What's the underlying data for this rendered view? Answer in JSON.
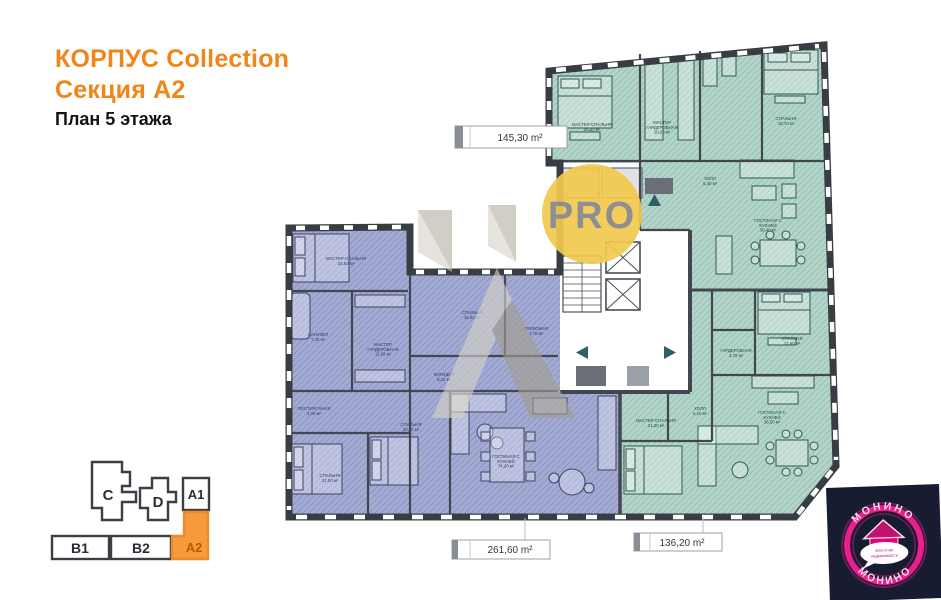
{
  "header": {
    "line1": "КОРПУС Collection",
    "line2": "Секция А2",
    "line3": "План 5 этажа"
  },
  "plan": {
    "area_labels": {
      "top": "145,30 m²",
      "bottom_left": "261,60 m²",
      "bottom_right": "136,20 m²"
    },
    "watermark": {
      "pro": "PRO"
    },
    "rooms": [
      {
        "label": "МАСТЕР-СПАЛЬНЯ",
        "area": "24,60 м²",
        "x": 346,
        "y": 260,
        "c": "purple"
      },
      {
        "label": "МАСТЕР ГАРДЕРОБНАЯ",
        "area": "11,00 м²",
        "x": 383,
        "y": 346,
        "c": "purple"
      },
      {
        "label": "САНУЗЕЛ",
        "area": "7,40 м²",
        "x": 318,
        "y": 336,
        "c": "purple"
      },
      {
        "label": "ПОСТИРОЧНАЯ",
        "area": "4,00 м²",
        "x": 314,
        "y": 410,
        "c": "purple"
      },
      {
        "label": "СПАЛЬНЯ",
        "area": "15,30 м²",
        "x": 472,
        "y": 314,
        "c": "purple"
      },
      {
        "label": "КОРИДОР",
        "area": "9,10 м²",
        "x": 444,
        "y": 376,
        "c": "purple"
      },
      {
        "label": "ПРИХОЖАЯ",
        "area": "4,70 м²",
        "x": 536,
        "y": 330,
        "c": "purple"
      },
      {
        "label": "СПАЛЬНЯ",
        "area": "21,00 м²",
        "x": 330,
        "y": 477,
        "c": "purple"
      },
      {
        "label": "СПАЛЬНЯ",
        "area": "20,30 м²",
        "x": 411,
        "y": 426,
        "c": "purple"
      },
      {
        "label": "ГОСТИНАЯ С КУХНЕЙ",
        "area": "74,20 м²",
        "x": 506,
        "y": 458,
        "c": "purple"
      },
      {
        "label": "МАСТЕР-СПАЛЬНЯ",
        "area": "26,50 м²",
        "x": 592,
        "y": 126,
        "c": "green"
      },
      {
        "label": "МАСТЕР ГАРДЕРОБНАЯ",
        "area": "10,20 м²",
        "x": 662,
        "y": 124,
        "c": "green"
      },
      {
        "label": "СПАЛЬНЯ",
        "area": "18,70 м²",
        "x": 786,
        "y": 120,
        "c": "green"
      },
      {
        "label": "ХОЛЛ",
        "area": "5,40 м²",
        "x": 710,
        "y": 180,
        "c": "green"
      },
      {
        "label": "ГОСТИНАЯ С КУХНЕЙ",
        "area": "39,40 м²",
        "x": 768,
        "y": 222,
        "c": "green"
      },
      {
        "label": "СПАЛЬНЯ",
        "area": "17,60 м²",
        "x": 792,
        "y": 340,
        "c": "green"
      },
      {
        "label": "ГАРДЕРОБНАЯ",
        "area": "4,70 м²",
        "x": 736,
        "y": 352,
        "c": "green"
      },
      {
        "label": "ХОЛЛ",
        "area": "6,10 м²",
        "x": 700,
        "y": 410,
        "c": "green"
      },
      {
        "label": "МАСТЕР-СПАЛЬНЯ",
        "area": "21,20 м²",
        "x": 656,
        "y": 422,
        "c": "green"
      },
      {
        "label": "ГОСТИНАЯ С КУХНЕЙ",
        "area": "36,50 м²",
        "x": 772,
        "y": 414,
        "c": "green"
      }
    ]
  },
  "minimap": {
    "sections": [
      {
        "id": "C"
      },
      {
        "id": "D"
      },
      {
        "id": "A1"
      },
      {
        "id": "B1"
      },
      {
        "id": "B2"
      },
      {
        "id": "A2"
      }
    ],
    "active": "A2"
  },
  "logo": {
    "name_top": "МОНИНО",
    "name_bottom": "МОНИНО",
    "tagline_line1": "агентство",
    "tagline_line2": "недвижимости"
  },
  "colors": {
    "accent_orange": "#F08519",
    "active_section_fill": "#F59B3D",
    "unit_purple": "#A3ABD4",
    "unit_green": "#B3D5C9",
    "wall": "#383D44",
    "brand_magenta": "#E6007E",
    "watermark_yellow": "#F2C94D"
  }
}
